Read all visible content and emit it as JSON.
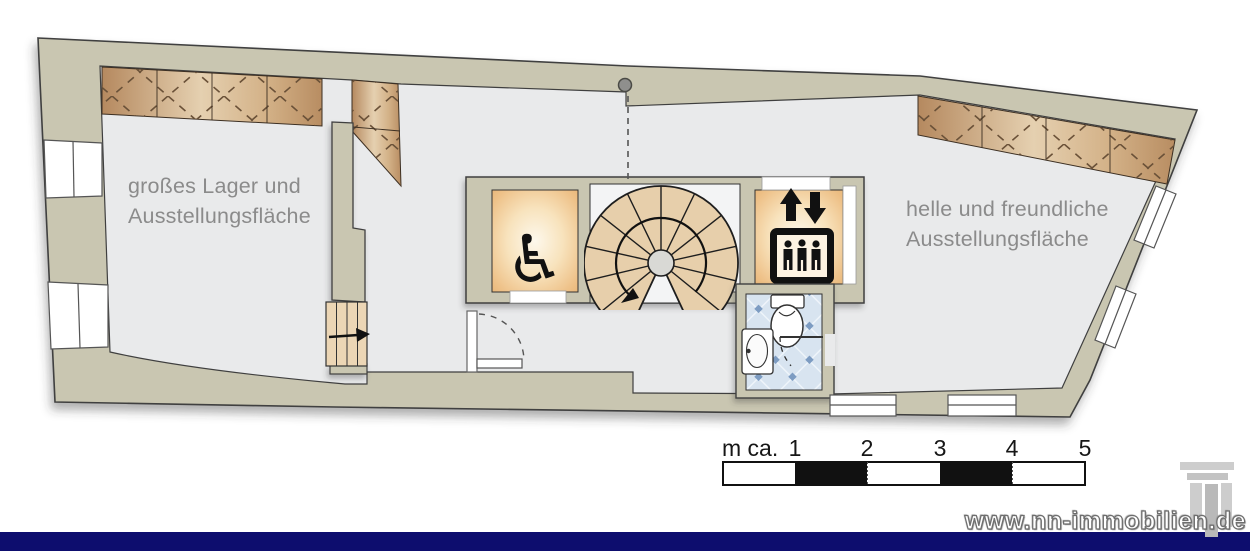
{
  "rooms": {
    "left": {
      "line1": "großes Lager und",
      "line2": "Ausstellungsfläche"
    },
    "right": {
      "line1": "helle und freundliche",
      "line2": "Ausstellungsfläche"
    }
  },
  "scale_bar": {
    "prefix": "m ca.",
    "ticks": [
      "1",
      "2",
      "3",
      "4",
      "5"
    ]
  },
  "footer": {
    "watermark": "www.nn-immobilien.de"
  },
  "glyphs": {
    "wheelchair": "♿"
  },
  "colors": {
    "wall": "#c9c6b1",
    "floor": "#e9eaeb",
    "navy": "#0d0d6e",
    "hatch_dark": "#b5895f",
    "hatch_light": "#e5d0b0",
    "room_glow": "#eec188",
    "tile_blue": "#7d9cc2",
    "stair_tread": "#e7cfab",
    "label_gray": "#8b8b8b"
  }
}
